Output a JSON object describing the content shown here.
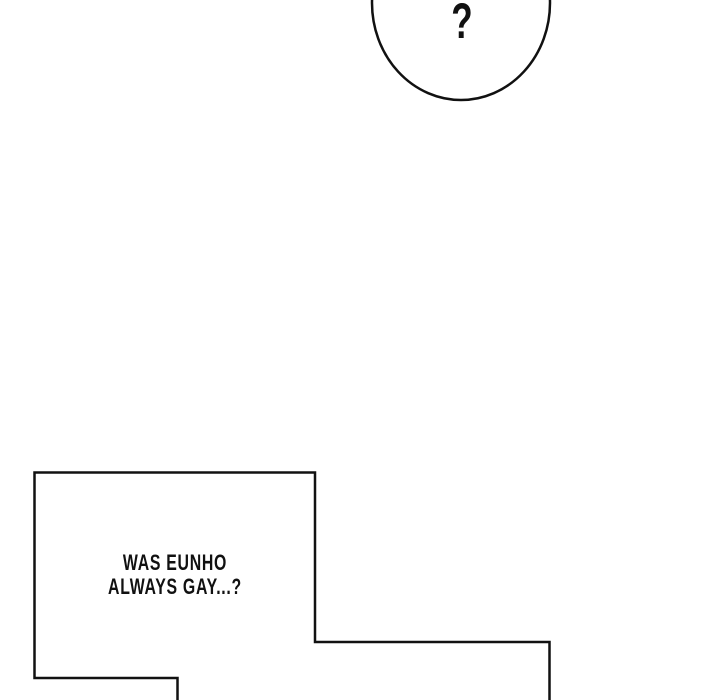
{
  "panel": {
    "type": "comic-panel",
    "background_color": "#ffffff",
    "line_color": "#111111",
    "text_color": "#111111",
    "fill_color": "#ffffff"
  },
  "bubbles": {
    "question": {
      "shape": "ellipse-cut-off-top",
      "text": "?"
    },
    "speech": {
      "shape": "stepped-rectangle-cut-off-bottom",
      "line1": "WAS EUNHO",
      "line2": "ALWAYS GAY...?"
    }
  }
}
